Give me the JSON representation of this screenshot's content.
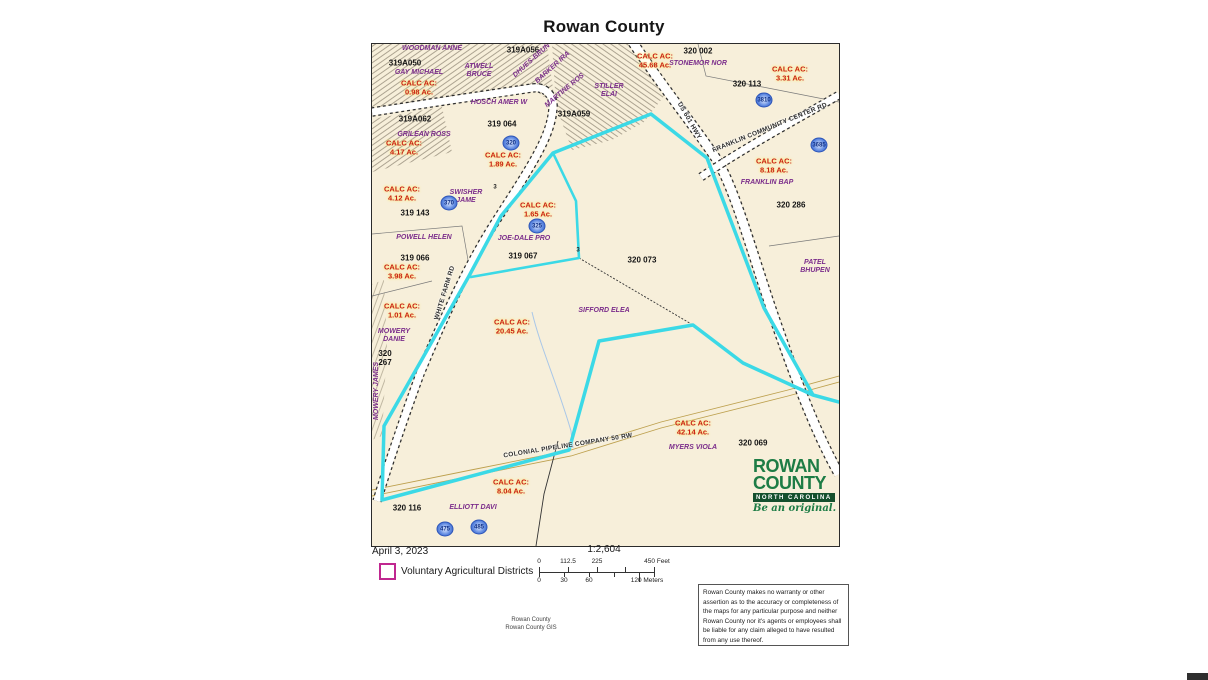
{
  "title": "Rowan County",
  "map": {
    "colors": {
      "background": "#f7efda",
      "vad_boundary": "#3bd9e6",
      "parcel_id": "#141414",
      "owner_name": "#7b2d8b",
      "calc_acreage": "#c92015",
      "calc_halo": "#ffec80",
      "legend_swatch": "#c02890",
      "pipeline": "#bda04e",
      "logo_green": "#1d7c45"
    },
    "calc_prefix": "CALC AC:",
    "parcel_ids": [
      {
        "text": "319A056",
        "x": 151,
        "y": 6
      },
      {
        "text": "319A050",
        "x": 33,
        "y": 19
      },
      {
        "text": "320 002",
        "x": 326,
        "y": 7
      },
      {
        "text": "320 113",
        "x": 375,
        "y": 40
      },
      {
        "text": "319A062",
        "x": 43,
        "y": 75
      },
      {
        "text": "319 064",
        "x": 130,
        "y": 80
      },
      {
        "text": "319A059",
        "x": 202,
        "y": 70
      },
      {
        "text": "319 143",
        "x": 43,
        "y": 169
      },
      {
        "text": "319 066",
        "x": 43,
        "y": 214
      },
      {
        "text": "319 067",
        "x": 151,
        "y": 212
      },
      {
        "text": "320 073",
        "x": 270,
        "y": 216
      },
      {
        "text": "320 286",
        "x": 419,
        "y": 161
      },
      {
        "text": "320\n267",
        "x": 13,
        "y": 314
      },
      {
        "text": "320 069",
        "x": 381,
        "y": 399
      },
      {
        "text": "320 116",
        "x": 35,
        "y": 464
      }
    ],
    "owners": [
      {
        "text": "WOODMAN ANNE",
        "x": 60,
        "y": 5
      },
      {
        "text": "GAY MICHAEL",
        "x": 47,
        "y": 29
      },
      {
        "text": "ATWELL\nBRUCE",
        "x": 107,
        "y": 27
      },
      {
        "text": "DHUES-BRUN",
        "x": 160,
        "y": 17,
        "rot": -42
      },
      {
        "text": "BARKER IRA",
        "x": 181,
        "y": 24,
        "rot": -42
      },
      {
        "text": "MARTINE ROS",
        "x": 193,
        "y": 47,
        "rot": -40
      },
      {
        "text": "STILLER\nELAI",
        "x": 237,
        "y": 47
      },
      {
        "text": "STONEMOR NOR",
        "x": 326,
        "y": 20
      },
      {
        "text": "GRILEAN ROSS",
        "x": 52,
        "y": 91
      },
      {
        "text": "HOSCH AMER W",
        "x": 127,
        "y": 59
      },
      {
        "text": "SWISHER\nJAME",
        "x": 94,
        "y": 153
      },
      {
        "text": "POWELL HELEN",
        "x": 52,
        "y": 194
      },
      {
        "text": "JOE-DALE PRO",
        "x": 152,
        "y": 195
      },
      {
        "text": "SIFFORD ELEA",
        "x": 232,
        "y": 267
      },
      {
        "text": "MOWERY\nDANIE",
        "x": 22,
        "y": 292
      },
      {
        "text": "MOWERY JAMES",
        "x": 5,
        "y": 347,
        "rot": -90
      },
      {
        "text": "PATEL\nBHUPEN",
        "x": 443,
        "y": 223
      },
      {
        "text": "FRANKLIN BAP",
        "x": 395,
        "y": 139
      },
      {
        "text": "MYERS VIOLA",
        "x": 321,
        "y": 404
      },
      {
        "text": "ELLIOTT DAVI",
        "x": 101,
        "y": 464
      }
    ],
    "calc_labels": [
      {
        "value": "0.98 Ac.",
        "x": 47,
        "y": 44
      },
      {
        "value": "4.17 Ac.",
        "x": 32,
        "y": 104
      },
      {
        "value": "45.68 Ac.",
        "x": 283,
        "y": 17
      },
      {
        "value": "3.31 Ac.",
        "x": 418,
        "y": 30
      },
      {
        "value": "1.89 Ac.",
        "x": 131,
        "y": 116
      },
      {
        "value": "4.12 Ac.",
        "x": 30,
        "y": 150
      },
      {
        "value": "1.65 Ac.",
        "x": 166,
        "y": 166
      },
      {
        "value": "8.18 Ac.",
        "x": 402,
        "y": 122
      },
      {
        "value": "3.98 Ac.",
        "x": 30,
        "y": 228
      },
      {
        "value": "1.01 Ac.",
        "x": 30,
        "y": 267
      },
      {
        "value": "20.45 Ac.",
        "x": 140,
        "y": 283
      },
      {
        "value": "42.14 Ac.",
        "x": 321,
        "y": 384
      },
      {
        "value": "8.04 Ac.",
        "x": 139,
        "y": 443
      }
    ],
    "road_labels": [
      {
        "text": "WHITE FARM RD",
        "x": 73,
        "y": 249,
        "rot": -73
      },
      {
        "text": "US 601 HWY",
        "x": 317,
        "y": 77,
        "rot": 60
      },
      {
        "text": "FRANKLIN COMMUNITY CENTER RD",
        "x": 398,
        "y": 84,
        "rot": -22
      },
      {
        "text": "COLONIAL PIPELINE COMPANY 50 RW",
        "x": 196,
        "y": 402,
        "rot": -9
      }
    ],
    "icons": [
      {
        "num": "320",
        "x": 139,
        "y": 99
      },
      {
        "num": "370",
        "x": 77,
        "y": 159
      },
      {
        "num": "325",
        "x": 165,
        "y": 182
      },
      {
        "num": "3810",
        "x": 392,
        "y": 56
      },
      {
        "num": "3685",
        "x": 447,
        "y": 101
      },
      {
        "num": "475",
        "x": 73,
        "y": 485
      },
      {
        "num": "485",
        "x": 107,
        "y": 483
      }
    ],
    "tiny_labels": [
      {
        "text": "3",
        "x": 206,
        "y": 207
      },
      {
        "text": "3",
        "x": 123,
        "y": 144
      }
    ]
  },
  "legend": {
    "date": "April 3, 2023",
    "vad_label": "Voluntary Agricultural Districts",
    "scale_ratio": "1:2,604",
    "feet_ticks": [
      "0",
      "112.5",
      "225",
      "450 Feet"
    ],
    "meter_ticks": [
      "0",
      "30",
      "60",
      "120 Meters"
    ]
  },
  "logo": {
    "line1": "ROWAN",
    "line2": "COUNTY",
    "line3": "NORTH CAROLINA",
    "tagline": "Be an original."
  },
  "credit": [
    "Rowan County",
    "Rowan County GIS"
  ],
  "disclaimer": "Rowan County makes no warranty or other assertion as to the accuracy or completeness of the maps for any particular purpose and neither Rowan County nor it's agents or employees shall be liable for any claim alleged to have resulted from any use thereof."
}
